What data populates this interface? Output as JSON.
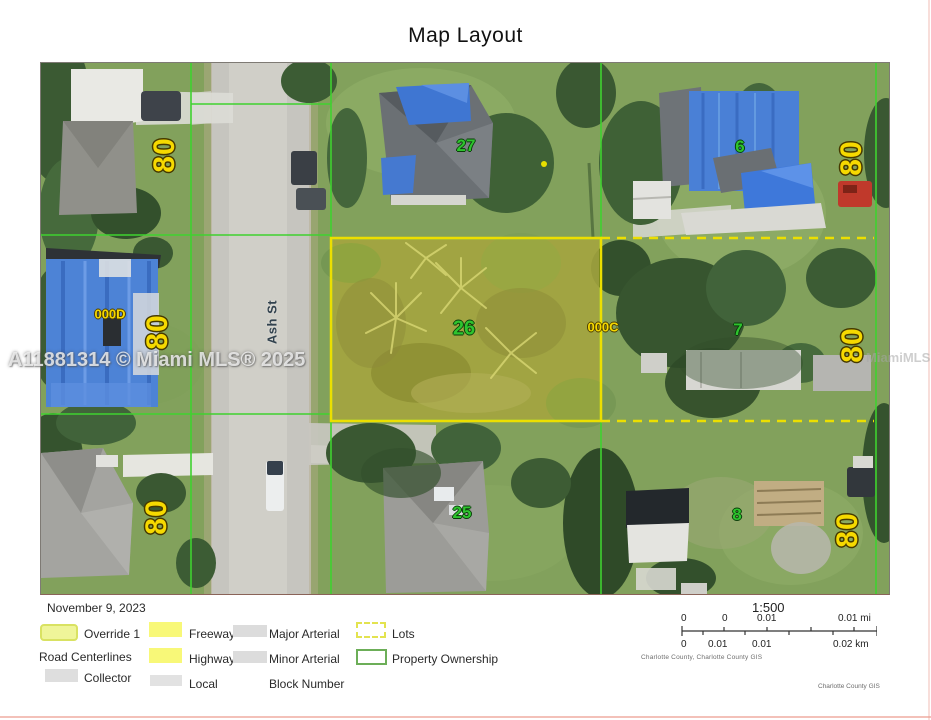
{
  "page": {
    "title": "Map Layout",
    "footer_credit": "Charlotte County GIS"
  },
  "map": {
    "street_label": "Ash St",
    "eighty_labels": [
      "80",
      "80",
      "80",
      "80",
      "80",
      "80"
    ],
    "parcel_numbers": {
      "top_center": "27",
      "top_right": "6",
      "highlighted": "26",
      "mid_right": "7",
      "bottom_center": "25",
      "bottom_right": "8"
    },
    "block_labels": {
      "west": "000D",
      "center": "000C"
    },
    "watermarks": {
      "left": "A11881314 © Miami MLS® 2025",
      "right": "MiamiMLS"
    }
  },
  "legend": {
    "date": "November 9, 2023",
    "override": "Override 1",
    "road_centerlines": "Road Centerlines",
    "collector": "Collector",
    "freeway": "Freeway",
    "highway": "Highway",
    "local": "Local",
    "major_arterial": "Major Arterial",
    "minor_arterial": "Minor Arterial",
    "block_number": "Block Number",
    "lots": "Lots",
    "property_ownership": "Property Ownership"
  },
  "scale": {
    "ratio": "1:500",
    "mi_ticks": [
      "0",
      "0",
      "0.01",
      "0.01 mi"
    ],
    "km_ticks": [
      "0",
      "0.01",
      "0.01",
      "0.02 km"
    ],
    "attribution": "Charlotte County, Charlotte County GIS"
  },
  "colors": {
    "highlight_fill": "#e8e400",
    "property_line": "#3fd22f",
    "label_yellow": "#f6d900",
    "parcel_green": "#2ec42e"
  }
}
